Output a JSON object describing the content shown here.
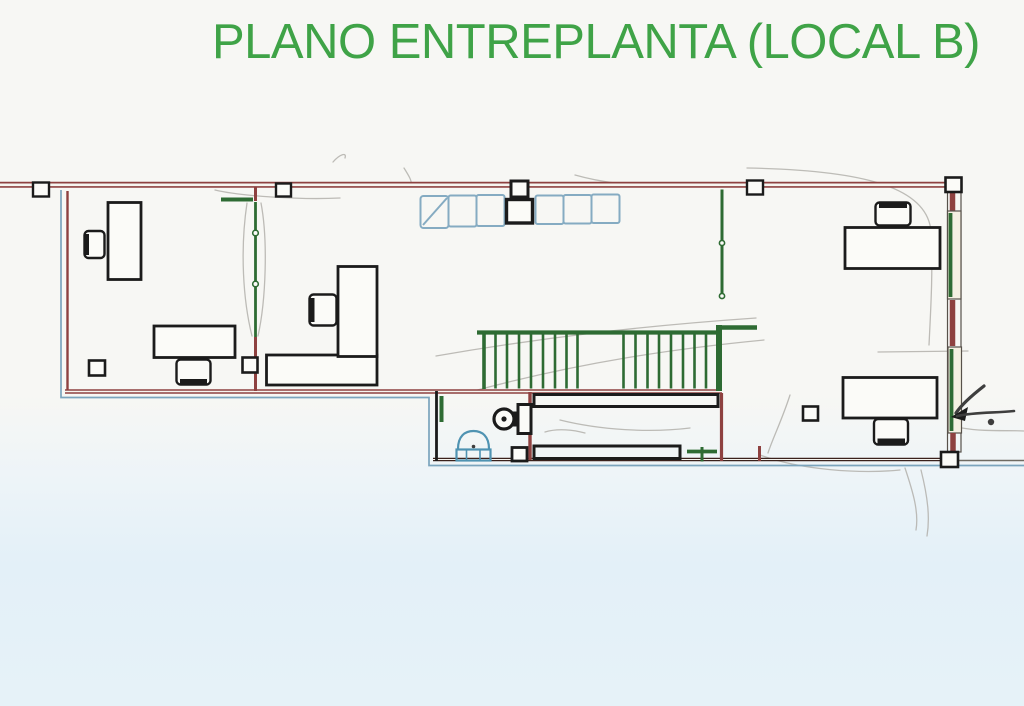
{
  "title": "PLANO ENTREPLANTA (LOCAL B)",
  "colors": {
    "title_green": "#3fa347",
    "wall_red": "#8e4140",
    "wall_dark": "#3a211c",
    "rail_green": "#2e6b33",
    "ink_black": "#1b1b1b",
    "outline_blue": "#7ba4bd",
    "cabinet_blue": "#85abc2",
    "sink_blue": "#4f93b2",
    "pencil_gray": "#b3b1ac",
    "pencil_dark": "#3e3e3e",
    "paper_line": "#f6f5f0",
    "furniture_fill": "#fbfbf8",
    "window_cream": "#f4f0e2",
    "paper_top": "#f7f7f4",
    "wash_blue": "#e3f0f8"
  },
  "plan": {
    "regions": [
      "left-office",
      "center-open-area",
      "stairs",
      "bathroom",
      "corridor",
      "right-office"
    ],
    "furniture_counts": {
      "desks": 5,
      "chairs": 5,
      "cabinet_units": 6,
      "toilets": 1,
      "sinks": 1,
      "wall_markers": 4,
      "corner_markers": 2,
      "windows": 2
    }
  }
}
